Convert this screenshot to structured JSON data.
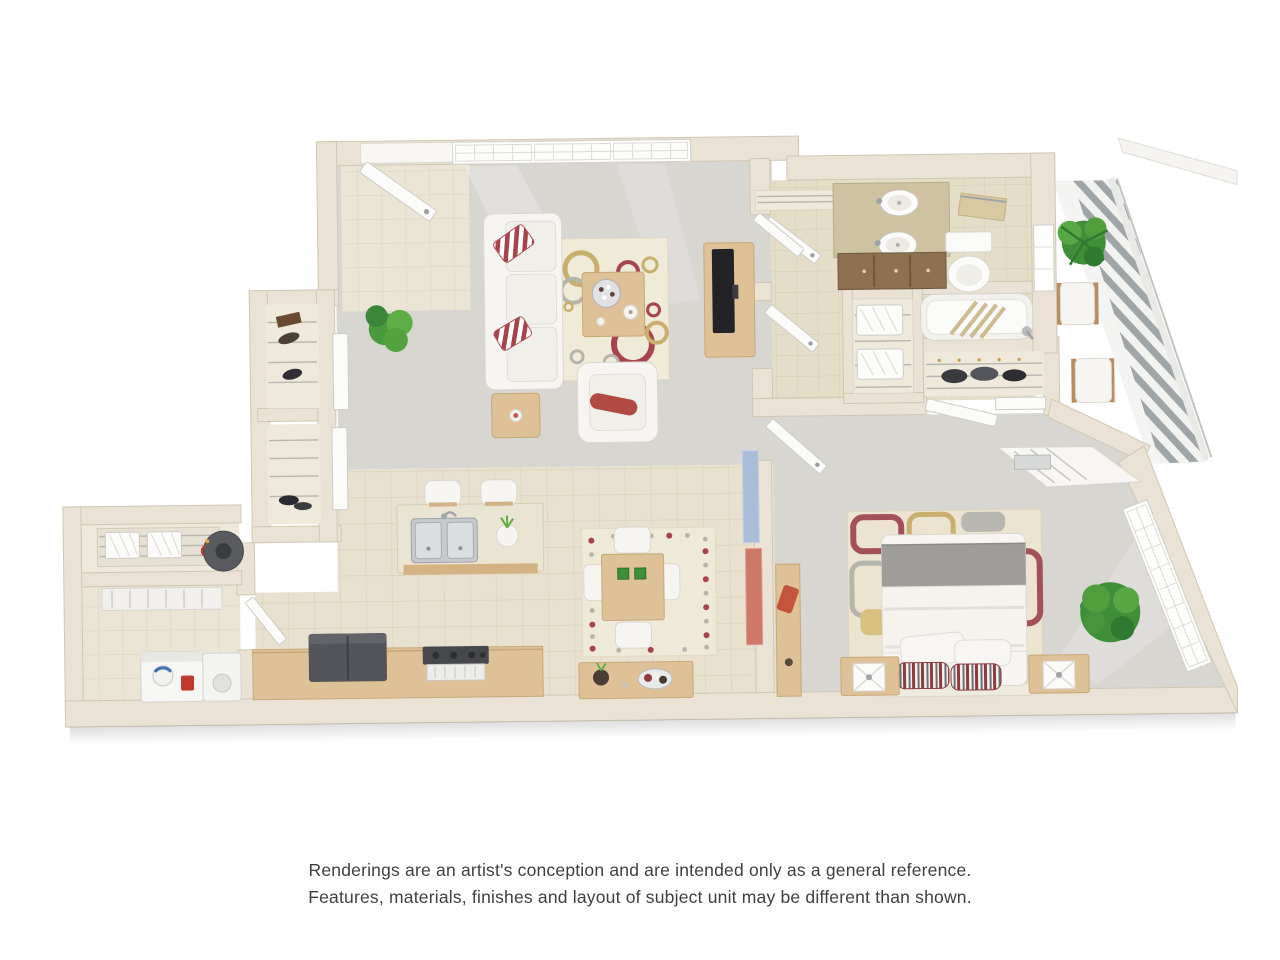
{
  "page": {
    "background": "#ffffff",
    "image_kind": "3d-top-down-floor-plan-rendering"
  },
  "disclaimer": {
    "line1": "Renderings are an artist's conception and are intended only as a general reference.",
    "line2": "Features, materials, finishes and layout of subject unit may be different than shown."
  },
  "palette": {
    "wall": "#e9e2d5",
    "wall_edge": "#d2c7b4",
    "wall_inner_face": "#efe9dc",
    "carpet": "#d8d6d1",
    "kitchen_tile": "#e8e1cf",
    "entry_tile": "#ebe5d5",
    "bath_tile": "#e4ddc8",
    "wood_light": "#dfc197",
    "wood_mid": "#d3b284",
    "cabinet_brown": "#8d7150",
    "white_furniture": "#f6f5f1",
    "appliance_dark": "#4b4b4f",
    "stainless": "#c7cacc",
    "accent_red": "#a8444c",
    "accent_gold": "#c9af6e",
    "accent_gray": "#b5b5ad",
    "plant_green": "#3f8f39",
    "art_blue": "#a9bcd8",
    "art_red": "#cd7868",
    "balcony_slat": "#a0a5a8",
    "text": "#3f3f3f"
  },
  "scene": {
    "unit": "one-bedroom-one-bath-apartment",
    "rooms": [
      {
        "name": "living-room",
        "items": [
          "entry-door",
          "picture-windows",
          "sectional-sofa",
          "striped-accent-pillows",
          "circle-pattern-rug",
          "coffee-table",
          "serving-tray",
          "armchair",
          "red-bolster-pillow",
          "side-table",
          "potted-plant",
          "tv-console",
          "television"
        ]
      },
      {
        "name": "entry",
        "items": [
          "tile-floor",
          "open-front-door"
        ]
      },
      {
        "name": "hall-closets",
        "items": [
          "wire-shelving",
          "shoes",
          "closet-doors"
        ]
      },
      {
        "name": "kitchen",
        "items": [
          "island",
          "double-sink",
          "faucet",
          "bar-stools",
          "flower-vase",
          "refrigerator",
          "range",
          "counter"
        ]
      },
      {
        "name": "dining-area",
        "items": [
          "dot-border-rug",
          "dining-table",
          "dining-chairs",
          "mini-planters",
          "console-table",
          "fruit-bowl",
          "dark-vase"
        ]
      },
      {
        "name": "bedroom",
        "items": [
          "rectangle-pattern-rug",
          "bed",
          "gray-throw",
          "white-pillows",
          "striped-pillows",
          "headboard",
          "nightstands",
          "table-lamps",
          "potted-shrub",
          "picture-window",
          "desk",
          "reach-in-closet",
          "closet-doors",
          "wall-art-blue",
          "wall-art-red",
          "ac-vent-panel"
        ]
      },
      {
        "name": "bathroom",
        "items": [
          "vanity-counter",
          "double-sinks",
          "wood-cabinets",
          "toilet",
          "towel-bar",
          "bathtub",
          "shower-head",
          "bath-window",
          "linen-closet",
          "wire-baskets",
          "doors"
        ]
      },
      {
        "name": "laundry-room",
        "items": [
          "storage-shelf",
          "storage-baskets",
          "water-heater",
          "drying-rack",
          "washer",
          "dryer",
          "detergent",
          "door"
        ]
      },
      {
        "name": "balcony",
        "items": [
          "slat-railing",
          "patio-chairs",
          "potted-palm",
          "roof-beam"
        ]
      }
    ]
  }
}
